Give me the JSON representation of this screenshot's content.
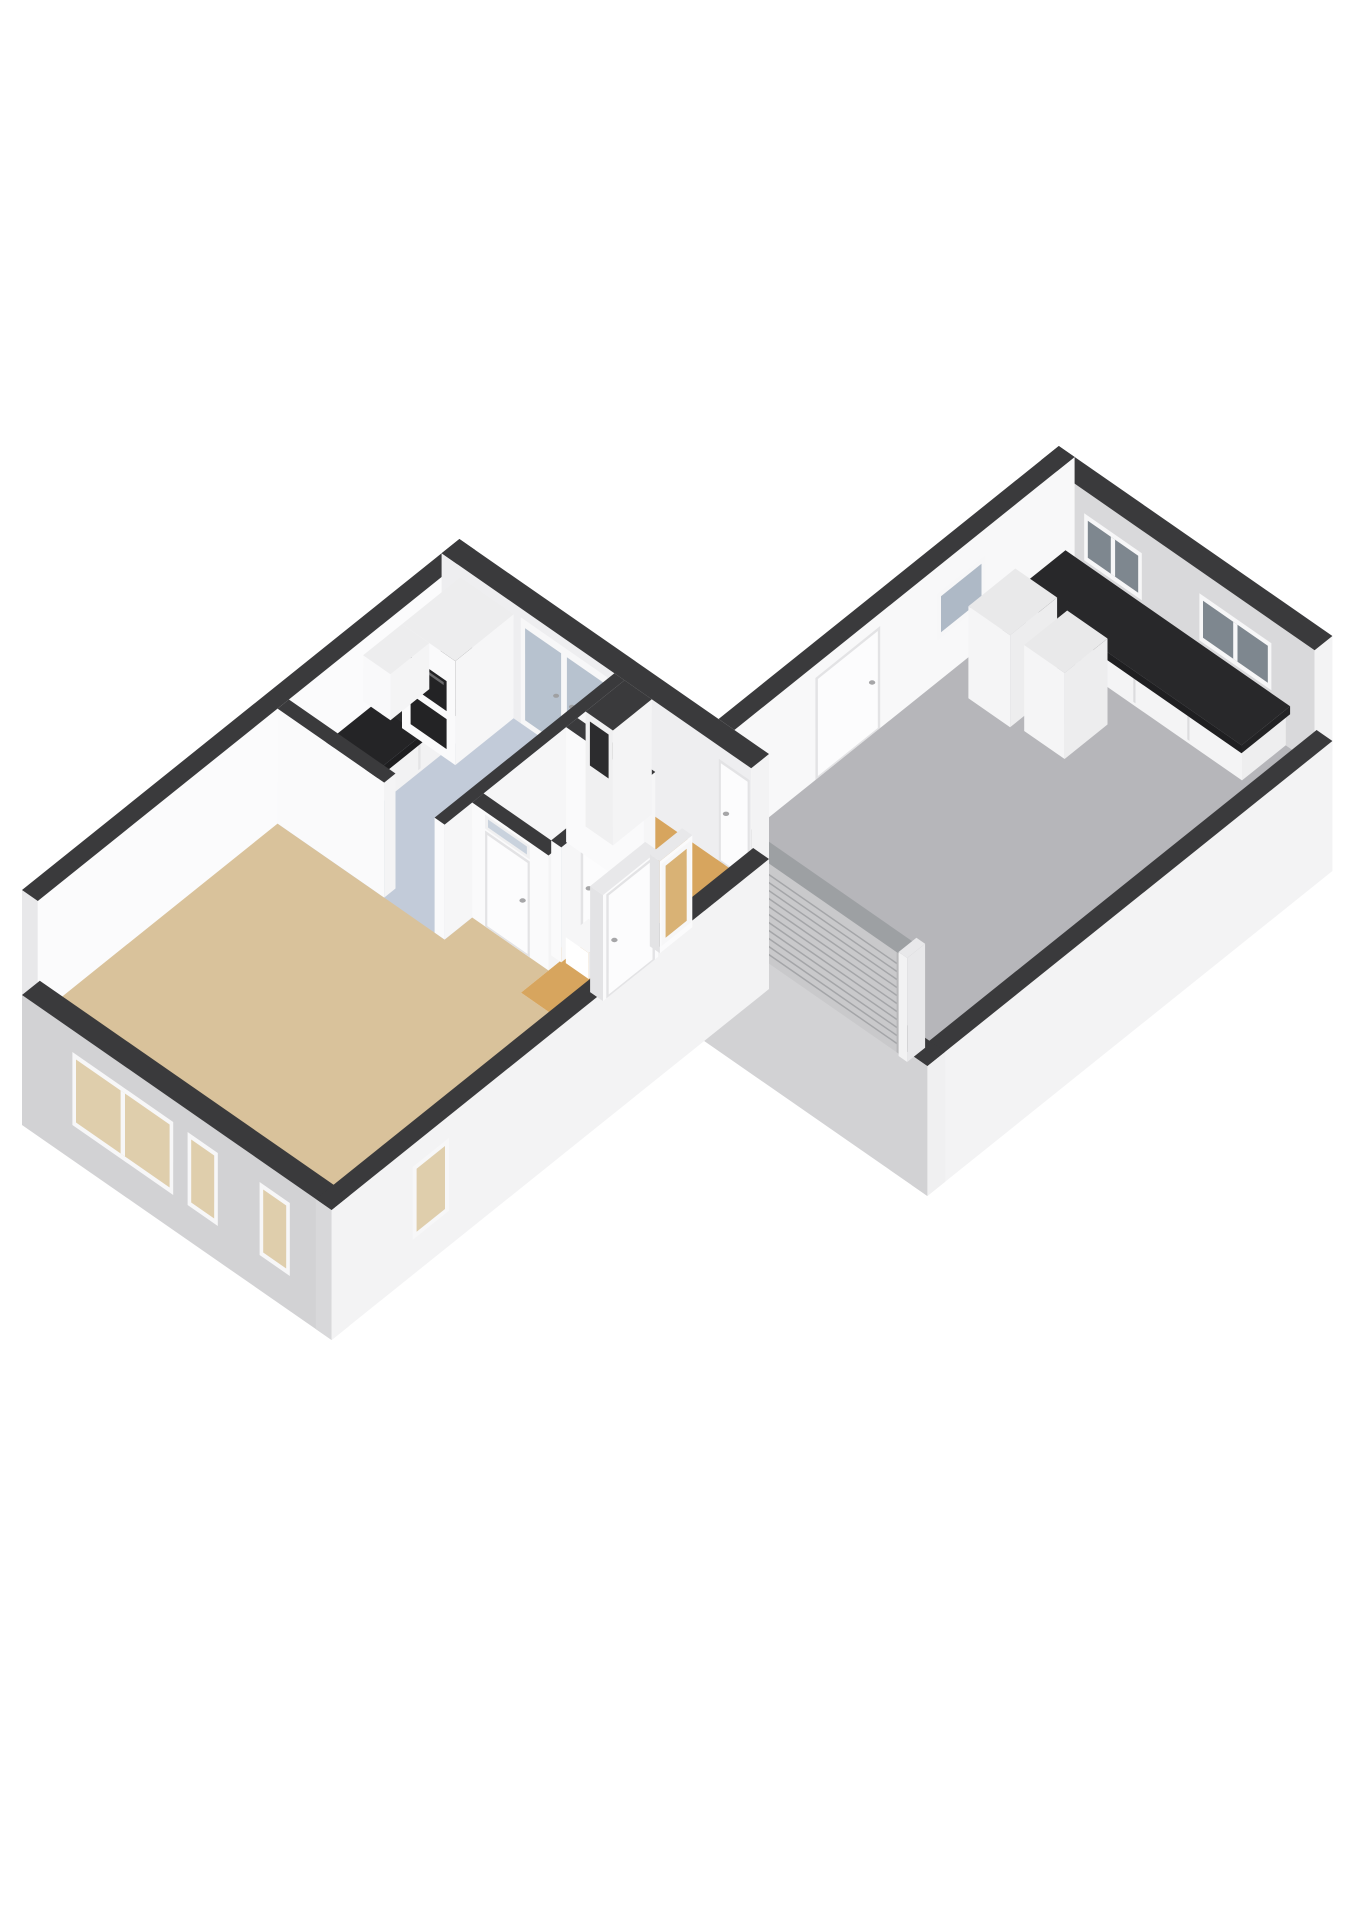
{
  "canvas": {
    "width": 1358,
    "height": 1920,
    "background": "#ffffff"
  },
  "diagram": {
    "type": "3d-floor-plan-isometric",
    "rooms": [
      {
        "id": "living-room",
        "floor_color": "#d9c29b"
      },
      {
        "id": "hallway",
        "floor_color": "#d7a55e"
      },
      {
        "id": "kitchen",
        "floor_color": "#c2cbd9"
      },
      {
        "id": "toilet",
        "floor_color": "#c3ccd9"
      },
      {
        "id": "garage",
        "floor_color": "#b6b6ba"
      }
    ],
    "fixtures": [
      "kitchen-counter",
      "kitchen-sink",
      "kitchen-hob",
      "kitchen-tall-unit",
      "kitchen-oven",
      "kitchen-upper-cabinet",
      "garage-workbench",
      "garage-appliance-1",
      "garage-appliance-2",
      "garage-roller-door",
      "meter-shaft",
      "hall-cabinet"
    ],
    "colors": {
      "wall_cut_top": "#3a3a3c",
      "wall_outer_light": "#d2d2d4",
      "wall_outer_bright": "#f3f3f4",
      "wall_inner_white": "#fafafb",
      "counter_dark": "#242426",
      "glass_blue": "#b7c2cf",
      "glass_dark": "#7e878f",
      "glass_tan": "#dfceac",
      "glass_amber": "#d9b275",
      "roller_grey": "#c9c9cb"
    }
  },
  "scene": {
    "projection": {
      "origin": [
        22,
        1005
      ],
      "ax": [
        0.72,
        0.5
      ],
      "ay": [
        0.81,
        -0.65
      ]
    },
    "elements": [
      {
        "t": "box",
        "name": "garage-ne-wall",
        "r": [
          360,
          938,
          740,
          960
        ],
        "z": [
          0,
          115
        ],
        "f": {
          "top": "#3a3a3c",
          "fy": "#d9d9db",
          "fx": "#f3f3f4"
        }
      },
      {
        "t": "decal",
        "name": "garage-window-ne-1",
        "face": "y",
        "c": 938,
        "u": [
          420,
          500
        ],
        "z": [
          45,
          92
        ],
        "kind": "window",
        "g": {
          "glass": "#7e878f",
          "m": [
            460
          ]
        }
      },
      {
        "t": "decal",
        "name": "garage-window-ne-2",
        "face": "y",
        "c": 938,
        "u": [
          580,
          680
        ],
        "z": [
          45,
          92
        ],
        "kind": "window",
        "g": {
          "glass": "#7e878f",
          "m": [
            630
          ]
        }
      },
      {
        "t": "box",
        "name": "garage-nw-wall",
        "r": [
          360,
          540,
          382,
          960
        ],
        "z": [
          0,
          115
        ],
        "f": {
          "top": "#3a3a3c",
          "fx": "#f8f8f9",
          "fy": "#d2d2d4"
        }
      },
      {
        "t": "decal",
        "name": "garage-side-door",
        "face": "x",
        "c": 382,
        "u": [
          640,
          720
        ],
        "z": [
          0,
          102
        ],
        "kind": "door",
        "g": {
          "h": "u1"
        }
      },
      {
        "t": "decal",
        "name": "garage-window-nw",
        "face": "x",
        "c": 382,
        "u": [
          790,
          850
        ],
        "z": [
          42,
          88
        ],
        "kind": "window",
        "g": {
          "glass": "#aeb9c6"
        }
      },
      {
        "t": "floor",
        "name": "garage-floor",
        "r": [
          382,
          482,
          718,
          938
        ],
        "fill": "#b6b6ba"
      },
      {
        "t": "box",
        "name": "garage-workbench-base",
        "r": [
          400,
          884,
          700,
          938
        ],
        "z": [
          0,
          34
        ],
        "f": {
          "fy": "#f4f4f5",
          "fx": "#eeeeef"
        }
      },
      {
        "t": "decal",
        "name": "workbench-seam-1",
        "face": "y",
        "c": 884,
        "u": [
          474,
          477
        ],
        "z": [
          3,
          31
        ],
        "kind": "panel",
        "g": {
          "fill": "#dcdcde"
        }
      },
      {
        "t": "decal",
        "name": "workbench-seam-2",
        "face": "y",
        "c": 884,
        "u": [
          549,
          552
        ],
        "z": [
          3,
          31
        ],
        "kind": "panel",
        "g": {
          "fill": "#dcdcde"
        }
      },
      {
        "t": "decal",
        "name": "workbench-seam-3",
        "face": "y",
        "c": 884,
        "u": [
          624,
          627
        ],
        "z": [
          3,
          31
        ],
        "kind": "panel",
        "g": {
          "fill": "#dcdcde"
        }
      },
      {
        "t": "box",
        "name": "garage-workbench-top",
        "r": [
          394,
          878,
          706,
          938
        ],
        "z": [
          34,
          42
        ],
        "f": {
          "top": "#28282a",
          "fy": "#1f1f21",
          "fx": "#232325"
        }
      },
      {
        "t": "box",
        "name": "garage-appliance-1",
        "r": [
          420,
          795,
          478,
          853
        ],
        "z": [
          0,
          92
        ],
        "f": {
          "top": "#e9e9ea",
          "fy": "#f5f5f6",
          "fx": "#ededee"
        }
      },
      {
        "t": "box",
        "name": "garage-appliance-2",
        "r": [
          492,
          800,
          548,
          853
        ],
        "z": [
          0,
          86
        ],
        "f": {
          "top": "#e9e9ea",
          "fy": "#f5f5f6",
          "fx": "#ededee"
        }
      },
      {
        "t": "box",
        "name": "garage-se-wall",
        "r": [
          718,
          460,
          740,
          960
        ],
        "z": [
          -120,
          10
        ],
        "f": {
          "top": "#3a3a3c",
          "fx": "#f3f3f4",
          "fy": "#d6d6d8"
        }
      },
      {
        "t": "box",
        "name": "garage-sw-wall",
        "r": [
          430,
          460,
          740,
          482
        ],
        "z": [
          -120,
          10
        ],
        "f": {
          "top": "#3a3a3c",
          "fy": "#d2d2d4",
          "fx": "#f0f0f1"
        }
      },
      {
        "t": "box",
        "name": "roller-door-rail-left",
        "r": [
          458,
          460,
          470,
          482
        ],
        "z": [
          0,
          104
        ],
        "f": {
          "top": "#e8e8ea",
          "fy": "#f2f2f3",
          "fx": "#e8e8ea"
        }
      },
      {
        "t": "box",
        "name": "garage-roller-door-slab",
        "r": [
          470,
          462,
          700,
          480
        ],
        "z": [
          0,
          100
        ],
        "f": {
          "top": "#9da0a3"
        }
      },
      {
        "t": "decal",
        "name": "garage-roller-door",
        "face": "y",
        "c": 462,
        "u": [
          470,
          700
        ],
        "z": [
          0,
          100
        ],
        "kind": "roller",
        "g": {}
      },
      {
        "t": "box",
        "name": "roller-door-rail-right",
        "r": [
          700,
          460,
          712,
          482
        ],
        "z": [
          0,
          104
        ],
        "f": {
          "top": "#e8e8ea",
          "fy": "#f2f2f3",
          "fx": "#e8e8ea"
        }
      },
      {
        "t": "box",
        "name": "house-nw-wall",
        "r": [
          0,
          0,
          22,
          540
        ],
        "z": [
          0,
          115
        ],
        "f": {
          "top": "#3a3a3c",
          "fx": "#fbfbfc",
          "fy": "#e8e8ea"
        }
      },
      {
        "t": "box",
        "name": "house-ne-wall",
        "r": [
          0,
          518,
          430,
          540
        ],
        "z": [
          0,
          115
        ],
        "f": {
          "top": "#3a3a3c",
          "fy": "#eeeef0",
          "fx": "#f3f3f4"
        }
      },
      {
        "t": "decal",
        "name": "kitchen-garden-door",
        "face": "y",
        "c": 518,
        "u": [
          110,
          230
        ],
        "z": [
          0,
          106
        ],
        "kind": "glassdoor",
        "g": {
          "glass": "#b7c2cf"
        }
      },
      {
        "t": "decal",
        "name": "hall-back-door",
        "face": "y",
        "c": 518,
        "u": [
          385,
          428
        ],
        "z": [
          0,
          102
        ],
        "kind": "door",
        "g": {
          "h": "u0"
        }
      },
      {
        "t": "floor",
        "name": "living-room-floor",
        "pts": [
          [
            22,
            22
          ],
          [
            408,
            22
          ],
          [
            408,
            296
          ],
          [
            360,
            296
          ],
          [
            360,
            344
          ],
          [
            22,
            344
          ]
        ],
        "fill": "#d9c29b"
      },
      {
        "t": "floor",
        "name": "hallway-floor",
        "pts": [
          [
            360,
            296
          ],
          [
            408,
            296
          ],
          [
            408,
            518
          ],
          [
            254,
            518
          ],
          [
            254,
            344
          ],
          [
            360,
            344
          ]
        ],
        "fill": "#d7a55e"
      },
      {
        "t": "floor",
        "name": "toilet-floor",
        "r": [
          254,
          344,
          348,
          446
        ],
        "fill": "#c3ccd9"
      },
      {
        "t": "floor",
        "name": "kitchen-floor",
        "r": [
          22,
          296,
          254,
          518
        ],
        "fill": "#c2cbd9"
      },
      {
        "t": "box",
        "name": "kitchen-counter-base",
        "r": [
          26,
          310,
          80,
          518
        ],
        "z": [
          0,
          34
        ],
        "f": {
          "fx": "#f2f2f3",
          "fy": "#f6f6f7"
        }
      },
      {
        "t": "decal",
        "name": "counter-seam-1",
        "face": "x",
        "c": 80,
        "u": [
          358,
          361
        ],
        "z": [
          3,
          31
        ],
        "kind": "panel",
        "g": {
          "fill": "#e4e4e6"
        }
      },
      {
        "t": "decal",
        "name": "counter-seam-2",
        "face": "x",
        "c": 80,
        "u": [
          418,
          421
        ],
        "z": [
          3,
          31
        ],
        "kind": "panel",
        "g": {
          "fill": "#e4e4e6"
        }
      },
      {
        "t": "decal",
        "name": "counter-seam-3",
        "face": "x",
        "c": 80,
        "u": [
          468,
          471
        ],
        "z": [
          3,
          31
        ],
        "kind": "panel",
        "g": {
          "fill": "#e4e4e6"
        }
      },
      {
        "t": "box",
        "name": "kitchen-counter-top",
        "r": [
          22,
          306,
          86,
          518
        ],
        "z": [
          34,
          42
        ],
        "f": {
          "top": "#242426",
          "fy": "#2a2a2c",
          "fx": "#1e1e20"
        }
      },
      {
        "t": "topdecal",
        "name": "kitchen-sink",
        "r": [
          32,
          322,
          76,
          368
        ],
        "zl": 42,
        "kind": "sink"
      },
      {
        "t": "topdecal",
        "name": "kitchen-hob",
        "r": [
          30,
          416,
          78,
          474
        ],
        "zl": 42,
        "kind": "hob"
      },
      {
        "t": "box",
        "name": "kitchen-tall-unit",
        "r": [
          26,
          446,
          100,
          518
        ],
        "z": [
          0,
          104
        ],
        "f": {
          "top": "#ededee",
          "fx": "#f6f6f7",
          "fy": "#fafafb"
        }
      },
      {
        "t": "decal",
        "name": "kitchen-oven",
        "face": "y",
        "c": 446,
        "u": [
          32,
          94
        ],
        "z": [
          10,
          78
        ],
        "kind": "ovens",
        "g": {}
      },
      {
        "t": "box",
        "name": "kitchen-upper-cabinet",
        "r": [
          26,
          398,
          64,
          446
        ],
        "z": [
          58,
          104
        ],
        "f": {
          "top": "#ededee",
          "fx": "#f4f4f5",
          "fy": "#f9f9fa"
        }
      },
      {
        "t": "box",
        "name": "partition-living-kitchen",
        "r": [
          22,
          296,
          170,
          310
        ],
        "z": [
          0,
          115
        ],
        "f": {
          "top": "#3a3a3c",
          "fy": "#fafafb",
          "fx": "#f4f4f5"
        }
      },
      {
        "t": "box",
        "name": "partition-kitchen-hall",
        "r": [
          240,
          296,
          254,
          518
        ],
        "z": [
          0,
          115
        ],
        "f": {
          "top": "#3a3a3c",
          "fy": "#fafafb",
          "fx": "#f6f6f7"
        }
      },
      {
        "t": "box",
        "name": "partition-hall-front",
        "r": [
          254,
          330,
          360,
          344
        ],
        "z": [
          0,
          115
        ],
        "f": {
          "top": "#3a3a3c",
          "fy": "#fafafb",
          "fx": "#f4f4f5"
        }
      },
      {
        "t": "decal",
        "name": "hall-door",
        "face": "y",
        "c": 330,
        "u": [
          272,
          334
        ],
        "z": [
          0,
          96
        ],
        "kind": "door",
        "g": {
          "h": "u1",
          "tz": [
            98,
            112
          ]
        }
      },
      {
        "t": "box",
        "name": "toilet-wall-se",
        "r": [
          348,
          344,
          362,
          460
        ],
        "z": [
          0,
          115
        ],
        "f": {
          "top": "#3a3a3c",
          "fx": "#f6f6f7",
          "fy": "#fafafb"
        }
      },
      {
        "t": "decal",
        "name": "toilet-door",
        "face": "x",
        "c": 362,
        "u": [
          368,
          420
        ],
        "z": [
          0,
          94
        ],
        "kind": "door",
        "g": {
          "h": "u0"
        }
      },
      {
        "t": "box",
        "name": "toilet-wall-ne",
        "r": [
          254,
          446,
          362,
          460
        ],
        "z": [
          0,
          115
        ],
        "f": {
          "top": "#3a3a3c",
          "fy": "#fafafb",
          "fx": "#f6f6f7"
        }
      },
      {
        "t": "box",
        "name": "meter-shaft",
        "r": [
          254,
          470,
          292,
          518
        ],
        "z": [
          0,
          115
        ],
        "f": {
          "top": "#3a3a3c",
          "fx": "#f4f4f5",
          "fy": "#f0f0f1"
        }
      },
      {
        "t": "decal",
        "name": "meter-shaft-vent",
        "face": "y",
        "c": 470,
        "u": [
          260,
          286
        ],
        "z": [
          64,
          108
        ],
        "kind": "panel",
        "g": {
          "fill": "#2c2c2e"
        }
      },
      {
        "t": "box",
        "name": "hall-cabinet",
        "r": [
          366,
          346,
          398,
          374
        ],
        "z": [
          0,
          26
        ],
        "f": {
          "top": "#f6f6f7",
          "fy": "#ffffff",
          "fx": "#ededee"
        }
      },
      {
        "t": "box",
        "name": "house-sw-wall",
        "r": [
          0,
          0,
          430,
          22
        ],
        "z": [
          -120,
          10
        ],
        "f": {
          "top": "#3a3a3c",
          "fy": "#d2d2d4",
          "fx": "#f0f0f1"
        }
      },
      {
        "t": "decal",
        "name": "living-window-large",
        "face": "y",
        "c": 0,
        "u": [
          70,
          210
        ],
        "z": [
          -85,
          -12
        ],
        "kind": "window",
        "g": {
          "glass": "#dfceac",
          "m": [
            140
          ]
        }
      },
      {
        "t": "decal",
        "name": "living-window-narrow-1",
        "face": "y",
        "c": 0,
        "u": [
          230,
          272
        ],
        "z": [
          -85,
          -12
        ],
        "kind": "window",
        "g": {
          "glass": "#dfceac"
        }
      },
      {
        "t": "decal",
        "name": "living-window-narrow-2",
        "face": "y",
        "c": 0,
        "u": [
          330,
          372
        ],
        "z": [
          -85,
          -12
        ],
        "kind": "window",
        "g": {
          "glass": "#dfceac"
        }
      },
      {
        "t": "box",
        "name": "house-se-wall",
        "r": [
          408,
          0,
          430,
          540
        ],
        "z": [
          -120,
          10
        ],
        "f": {
          "top": "#3a3a3c",
          "fx": "#f3f3f4",
          "fy": "#d8d8da"
        }
      },
      {
        "t": "decal",
        "name": "se-window-narrow",
        "face": "x",
        "c": 430,
        "u": [
          100,
          145
        ],
        "z": [
          -85,
          -12
        ],
        "kind": "window",
        "g": {
          "glass": "#dfceac"
        }
      },
      {
        "t": "box",
        "name": "front-door-slab",
        "r": [
          411,
          336,
          429,
          404
        ],
        "z": [
          0,
          106
        ],
        "f": {
          "top": "#e8e8ea",
          "fx": "#fbfbfc",
          "fy": "#e3e3e5"
        }
      },
      {
        "t": "decal",
        "name": "front-door",
        "face": "x",
        "c": 429,
        "u": [
          340,
          400
        ],
        "z": [
          0,
          104
        ],
        "kind": "door",
        "g": {
          "h": "u0"
        }
      },
      {
        "t": "box",
        "name": "front-sidelight-slab",
        "r": [
          413,
          408,
          427,
          448
        ],
        "z": [
          0,
          92
        ],
        "f": {
          "top": "#e8e8ea",
          "fx": "#fbfbfc",
          "fy": "#e3e3e5"
        }
      },
      {
        "t": "decal",
        "name": "front-sidelight-window",
        "face": "x",
        "c": 427,
        "u": [
          410,
          446
        ],
        "z": [
          6,
          88
        ],
        "kind": "window",
        "g": {
          "glass": "#d9b275"
        }
      }
    ]
  }
}
